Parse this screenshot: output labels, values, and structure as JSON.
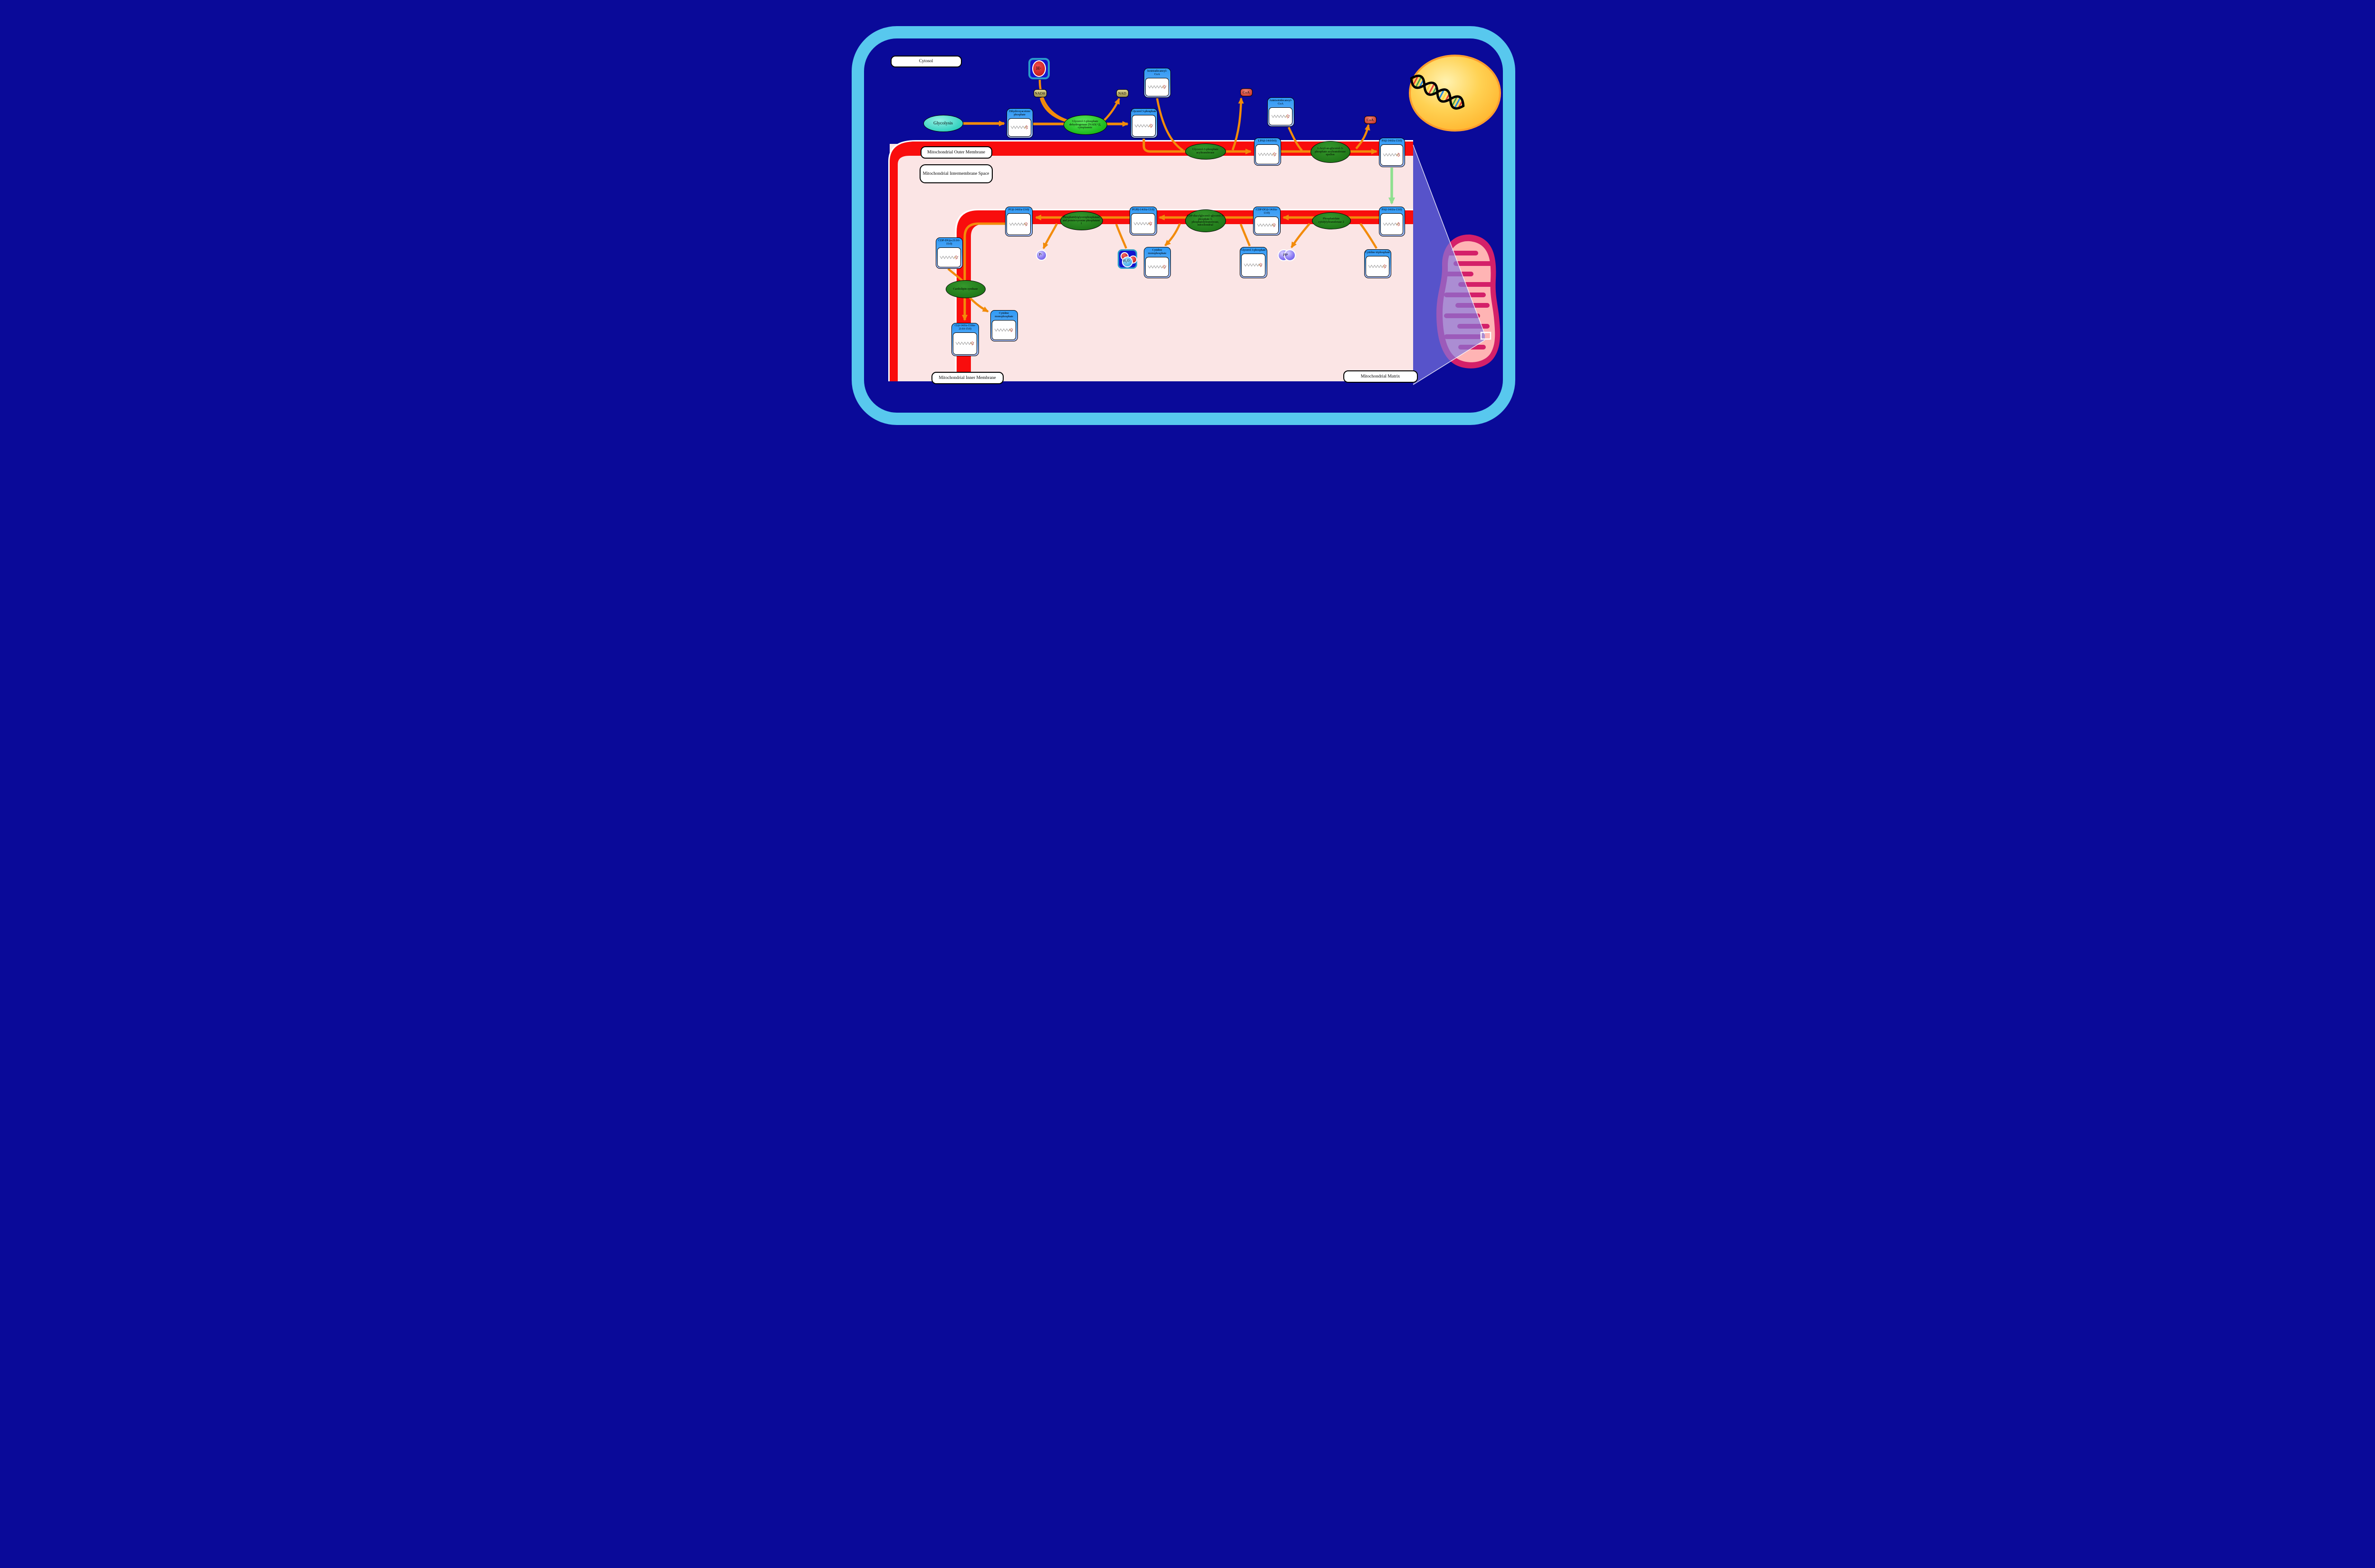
{
  "diagram": {
    "kind": "metabolic-pathway",
    "subject": "Cardiolipin biosynthesis across mitochondrial membranes"
  },
  "compartments": {
    "cytosol": {
      "label": "Cytosol"
    },
    "outer_membrane": {
      "label": "Mitochondrial Outer Membrane"
    },
    "intermembrane_space": {
      "label": "Mitochondrial Intermembrane Space"
    },
    "inner_membrane": {
      "label": "Mitochondrial Inner Membrane"
    },
    "matrix": {
      "label": "Mitochondrial Matrix"
    }
  },
  "process_nodes": [
    {
      "id": "glycolysis",
      "label": "Glycolysis"
    }
  ],
  "metabolite_cards": [
    {
      "id": "dhap",
      "label": "Dihydroxyacetone phosphate"
    },
    {
      "id": "g3p_top",
      "label": "Glycerol 3-phosphate"
    },
    {
      "id": "iso",
      "label": "Isotetradecanoyl-CoA"
    },
    {
      "id": "lpa",
      "label": "LPA(i-14:0/0:0)"
    },
    {
      "id": "anteiso",
      "label": "Anteisotridecanoyl-CoA"
    },
    {
      "id": "pa_outer",
      "label": "PA(i-14:0/a-13:0)"
    },
    {
      "id": "pa_inner",
      "label": "PA(i-14:0/a-13:0)"
    },
    {
      "id": "cdp_dg_mid",
      "label": "CDP-DG(i-14:0/a-13:0)"
    },
    {
      "id": "pgp",
      "label": "PGP(i-14:0/a-13:0)"
    },
    {
      "id": "pg",
      "label": "PG(i-14:0/a-13:0)"
    },
    {
      "id": "cmp_mid",
      "label": "Cytidine monophosphate"
    },
    {
      "id": "g3p_bottom",
      "label": "Glycerol 3-phosphate"
    },
    {
      "id": "ctp",
      "label": "Cytidine triphosphate"
    },
    {
      "id": "cdp_dg_left",
      "label": "CDP-DG(a-21:0/i-15:0)"
    },
    {
      "id": "cmp_bottom",
      "label": "Cytidine monophosphate"
    },
    {
      "id": "cl",
      "label": "CL(i-14:0/a-13:0/a-21:0/i-15:0)"
    }
  ],
  "enzymes": [
    {
      "id": "gpd",
      "label": "Glycerol-3-phosphate dehydrogenase [NAD(+)], cytoplasmic",
      "location": "cytosol"
    },
    {
      "id": "gpat",
      "label": "Glycerol-3-phosphate acyltransferase",
      "location": "outer membrane"
    },
    {
      "id": "agpat",
      "label": "1-Acyl-sn-glycerol-3-phosphate acyltransferase epsilon",
      "location": "outer membrane"
    },
    {
      "id": "pct2",
      "label": "Phosphatidate cytidylyltransferase 2",
      "location": "inner membrane"
    },
    {
      "id": "cdgpt",
      "label": "CDP-diacylglycerol--glycerol-3-phosphate 3-phosphatidyltransferase, mitochondrial",
      "location": "inner membrane"
    },
    {
      "id": "pgpp",
      "label": "Phosphatidylglycerophosphatase and protein-tyrosine phosphatase 1",
      "location": "inner membrane"
    },
    {
      "id": "cls",
      "label": "Cardiolipin synthase",
      "location": "inner membrane"
    }
  ],
  "cofactors": [
    {
      "id": "nadh",
      "label": "NADH",
      "style": "khaki"
    },
    {
      "id": "nad",
      "label": "NAD",
      "style": "khaki"
    },
    {
      "id": "coa1",
      "label": "CoA",
      "style": "red"
    },
    {
      "id": "coa2",
      "label": "CoA",
      "style": "red"
    },
    {
      "id": "hplus",
      "label": "H+",
      "style": "proton"
    },
    {
      "id": "h2o",
      "label": "H2O",
      "style": "water"
    },
    {
      "id": "pi",
      "label": "Pi",
      "style": "phosphate"
    },
    {
      "id": "ppi",
      "label": "PPi",
      "style": "phosphate"
    }
  ],
  "icons": [
    {
      "name": "nucleus-icon",
      "meaning": "cell nucleus with DNA double helix"
    },
    {
      "name": "dna-helix-icon",
      "meaning": "DNA double helix"
    },
    {
      "name": "mitochondrion-icon",
      "meaning": "mitochondrion with cristae"
    },
    {
      "name": "zoom-callout-icon",
      "meaning": "magnified membrane region indicator"
    }
  ],
  "colors": {
    "background_blue": "#0A0A99",
    "cell_border_blue": "#58C8EE",
    "membrane_red": "#F90D0D",
    "intermembrane_pink": "#FBE5E5",
    "card_blue_top": "#2E9AF7",
    "card_blue_bottom": "#AFC2FB",
    "enzyme_green_cytosolic": "#1EBB1E",
    "enzyme_green_membrane": "#217A1A",
    "arrow_orange": "#F28B0A",
    "transport_arrow_green": "#8FE08F",
    "cofactor_khaki": "#BCB06C",
    "coa_red": "#CD4033",
    "phosphate_purple": "#8C7BF2",
    "nucleus_yellow": "#FFC23E",
    "mitochondrion_crimson": "#D42069",
    "mitochondrion_matrix_pink": "#FFB4B4",
    "projection_purple": "rgba(128,122,228,0.66)"
  }
}
